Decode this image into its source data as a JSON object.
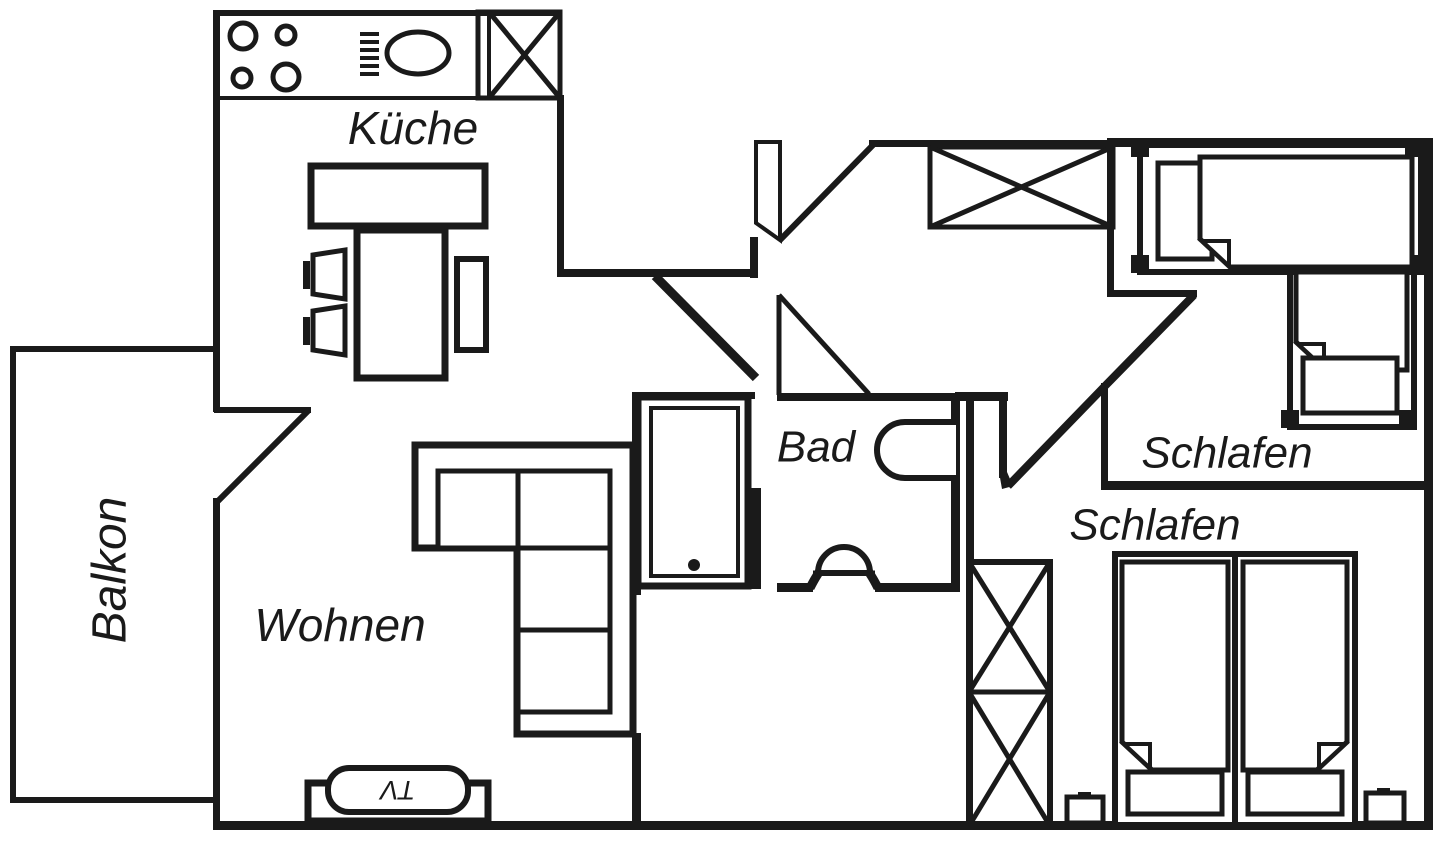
{
  "floor_plan": {
    "labels": {
      "balcony": "Balkon",
      "kitchen": "Küche",
      "living_room": "Wohnen",
      "bathroom": "Bad",
      "bedroom_right": "Schlafen",
      "bedroom_bottom": "Schlafen",
      "tv": "TV"
    },
    "colors": {
      "line": "#1a1a1a",
      "background": "#ffffff"
    }
  }
}
